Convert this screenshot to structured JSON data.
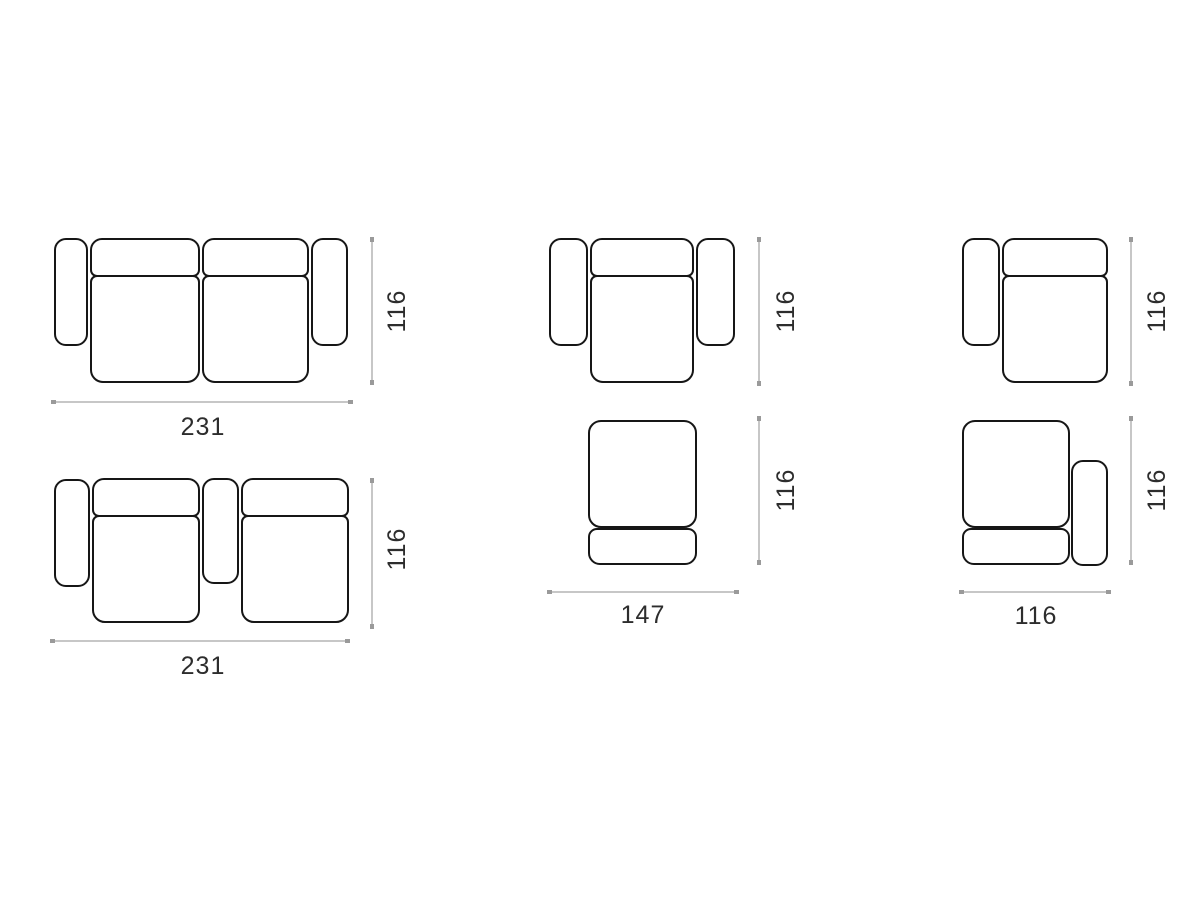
{
  "colors": {
    "background": "#ffffff",
    "outline": "#161616",
    "dimension_line": "#c7c7c7",
    "dimension_cap": "#9a9a9a",
    "label_text": "#2d2d2d"
  },
  "figures": {
    "sofa_two_seater": {
      "width": "231",
      "height": "116"
    },
    "sofa_two_seater_center_armrest": {
      "width": "231",
      "height": "116"
    },
    "armchair": {
      "height": "116"
    },
    "seat_module": {
      "width": "147",
      "height": "116"
    },
    "module_left_armrest": {
      "height": "116"
    },
    "module_right_armrest": {
      "width": "116",
      "height": "116"
    }
  }
}
